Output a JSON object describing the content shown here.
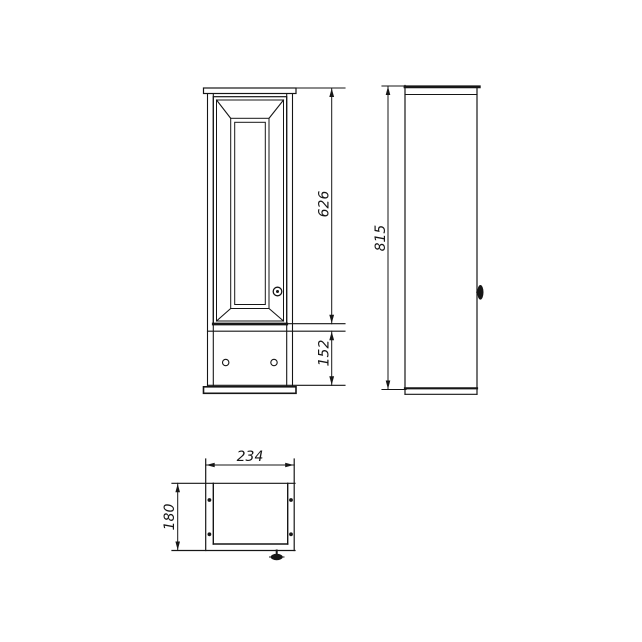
{
  "colors": {
    "line": "#161616",
    "background": "#ffffff"
  },
  "dimensions": {
    "door_height": "626",
    "lower_panel_height": "152",
    "total_height": "815",
    "width": "234",
    "depth": "180"
  }
}
